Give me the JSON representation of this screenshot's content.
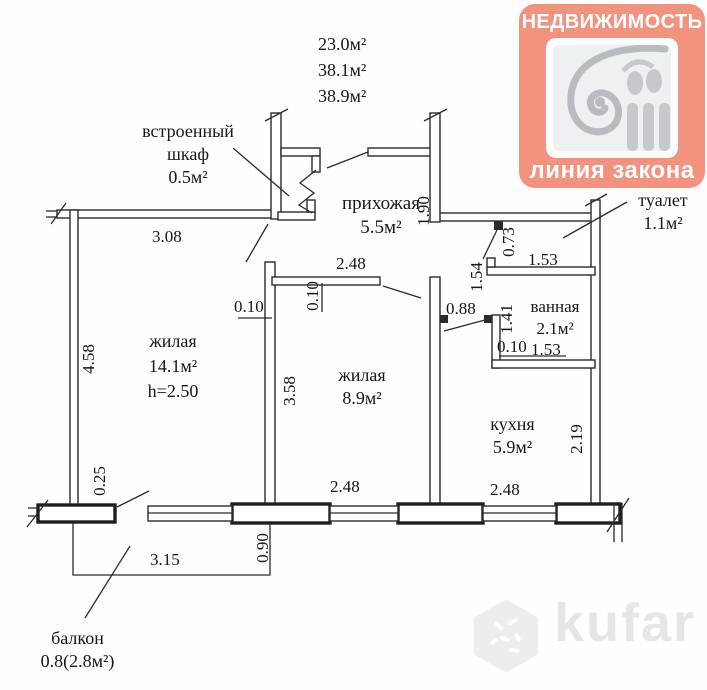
{
  "brand": {
    "title": "НЕДВИЖИМОСТЬ",
    "subtitle": "линия закона",
    "bg_color": "#f1937e",
    "icon": "column-capital-icon"
  },
  "totals": {
    "line1": "23.0м²",
    "line2": "38.1м²",
    "line3": "38.9м²"
  },
  "rooms": {
    "closet": {
      "l1": "встроенный",
      "l2": "шкаф",
      "l3": "0.5м²"
    },
    "hallway": {
      "l1": "прихожая",
      "l2": "5.5м²"
    },
    "toilet": {
      "l1": "туалет",
      "l2": "1.1м²"
    },
    "bathroom": {
      "l1": "ванная",
      "l2": "2.1м²"
    },
    "living1": {
      "l1": "жилая",
      "l2": "14.1м²",
      "l3": "h=2.50"
    },
    "living2": {
      "l1": "жилая",
      "l2": "8.9м²"
    },
    "kitchen": {
      "l1": "кухня",
      "l2": "5.9м²"
    },
    "balcony": {
      "l1": "балкон",
      "l2": "0.8(2.8м²)"
    }
  },
  "dims": {
    "w_3_08": "3.08",
    "h_1_90": "1.90",
    "h_0_73": "0.73",
    "w_1_53_toilet": "1.53",
    "h_1_54": "1.54",
    "w_0_88": "0.88",
    "h_1_41": "1.41",
    "w_0_10_bath": "0.10",
    "w_1_53_bath": "1.53",
    "w_2_48_hall": "2.48",
    "w_0_10_wall": "0.10",
    "h_0_10_wall": "0.10",
    "h_4_58": "4.58",
    "h_3_58": "3.58",
    "h_2_19": "2.19",
    "h_0_25": "0.25",
    "w_2_48_left": "2.48",
    "w_2_48_right": "2.48",
    "h_0_90": "0.90",
    "w_3_15": "3.15"
  },
  "watermark": {
    "text": "kufar",
    "icon": "kufar-hex-icon"
  }
}
